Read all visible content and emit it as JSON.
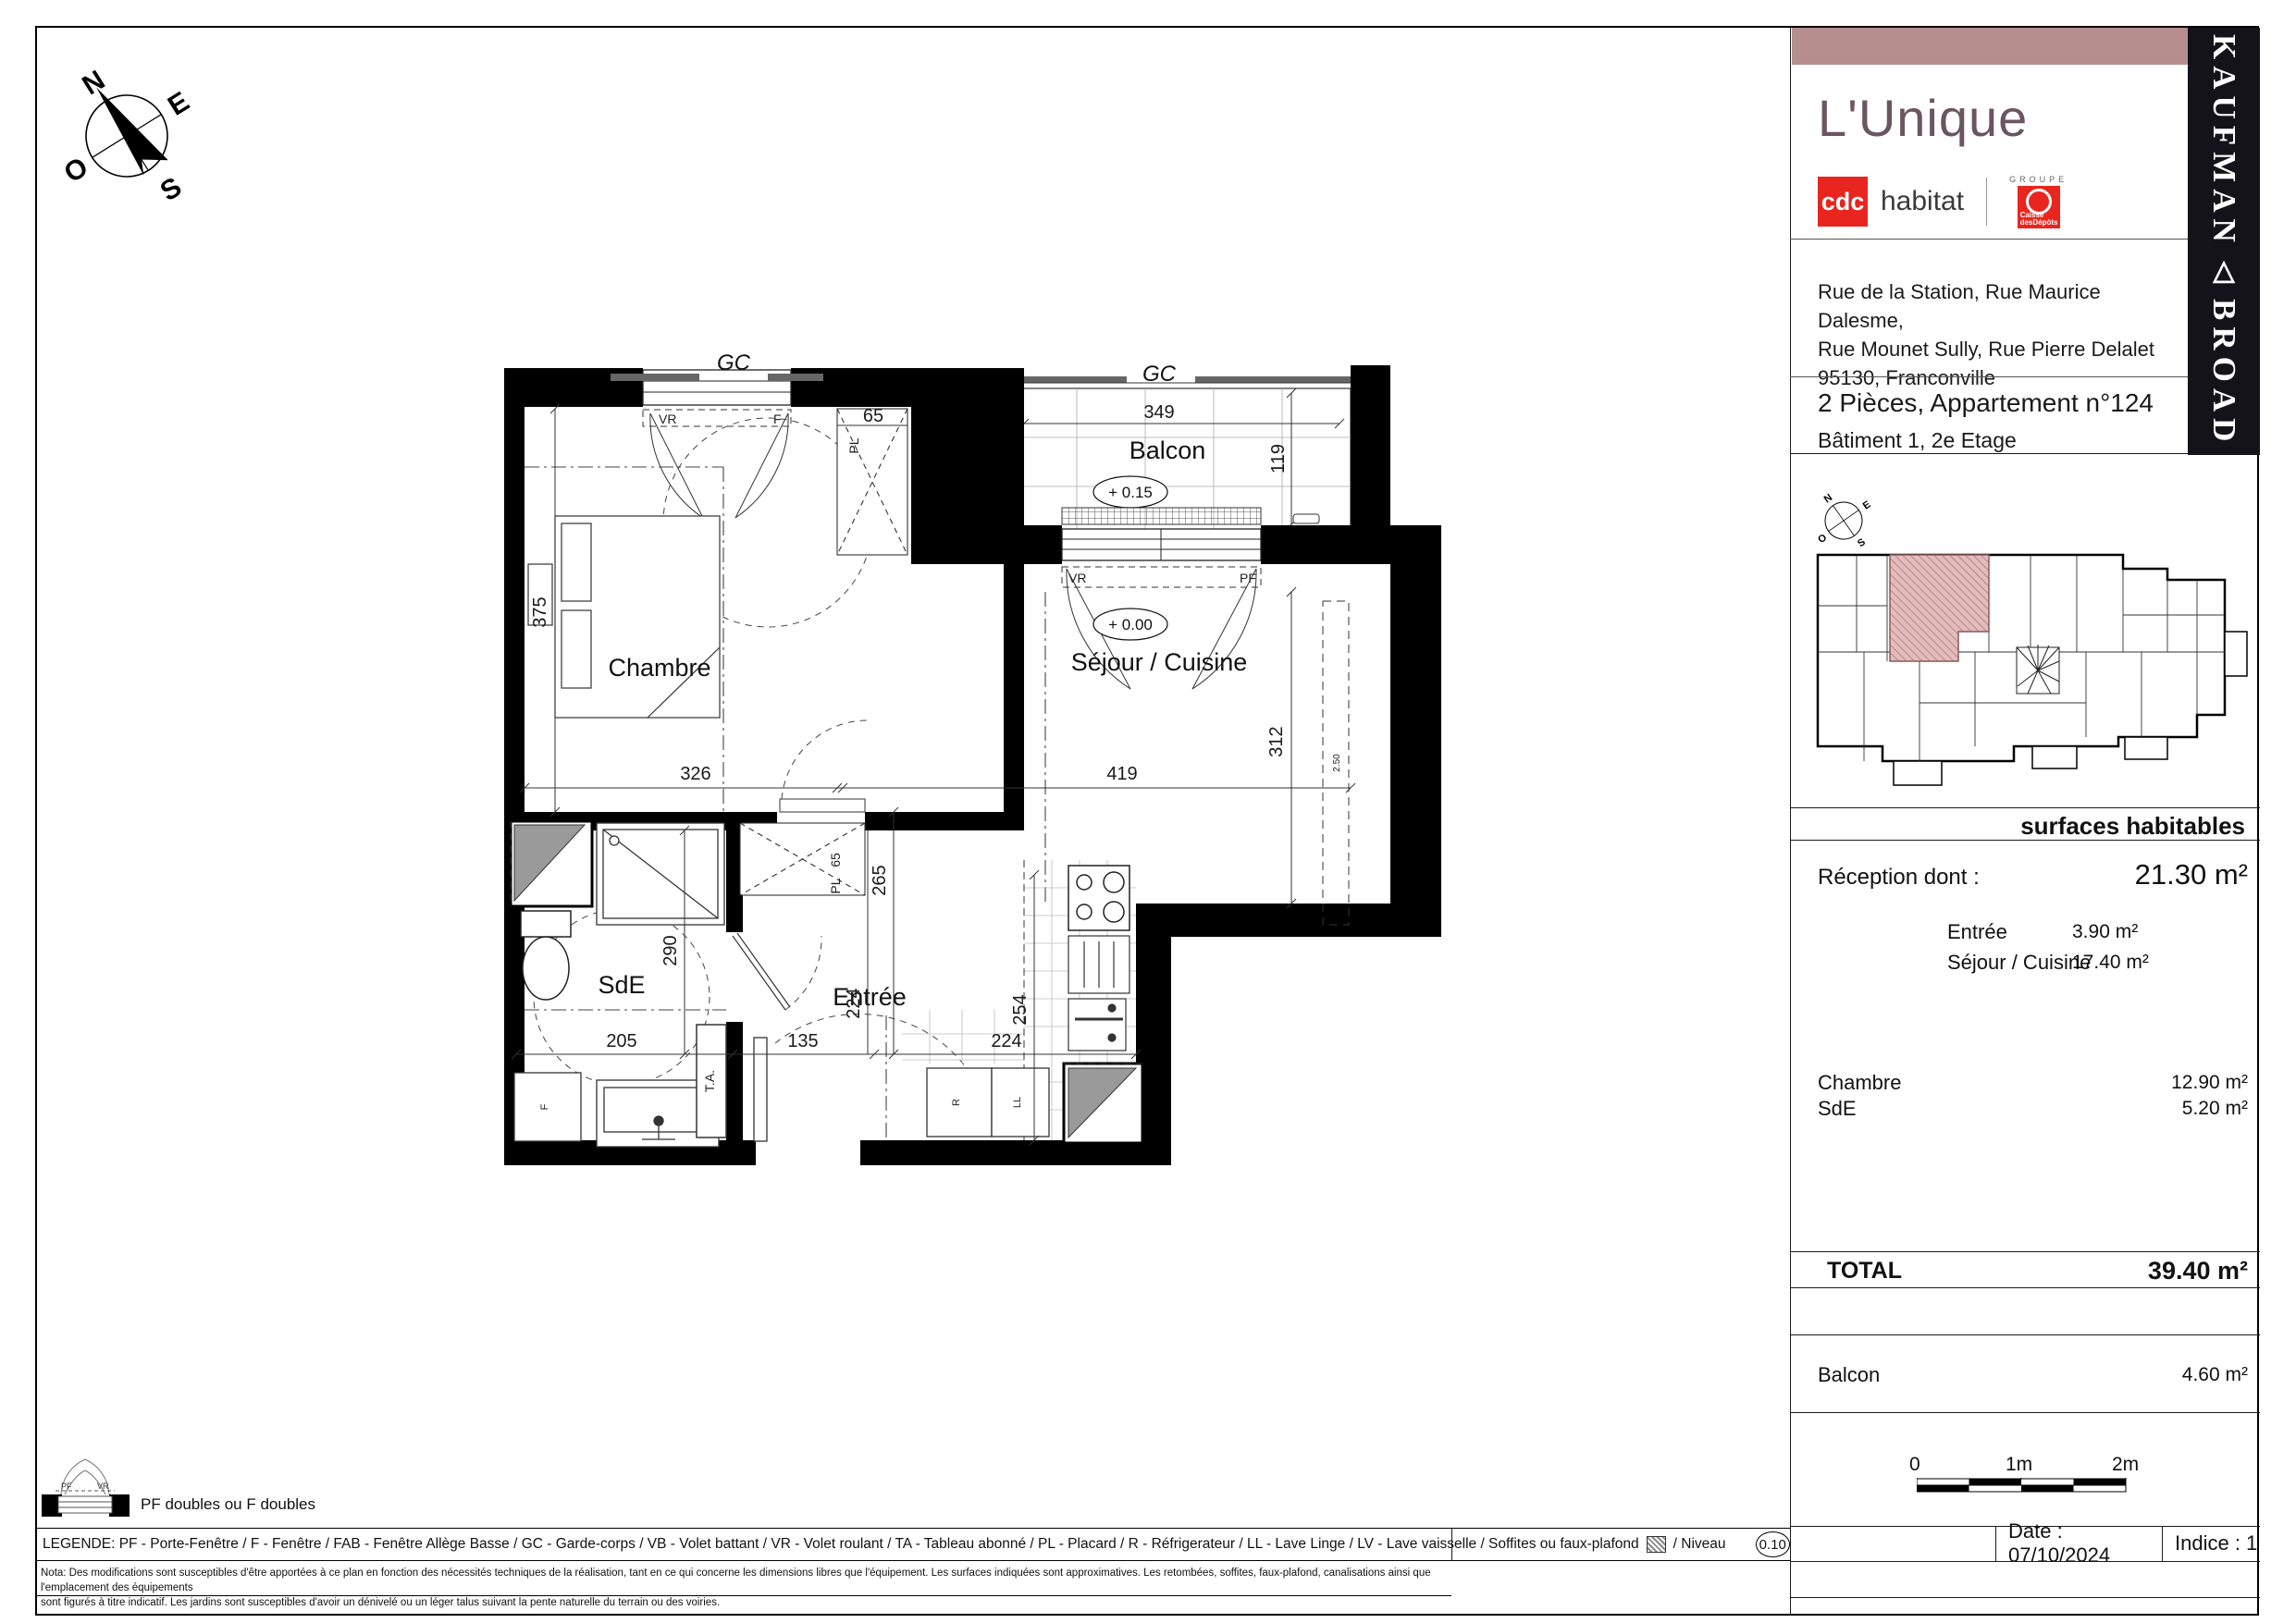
{
  "panel": {
    "title": "L'Unique",
    "brand": {
      "cdc": "cdc",
      "habitat": "habitat",
      "groupe": "GROUPE",
      "caisse_line1": "Caisse",
      "caisse_line2": "desDépôts"
    },
    "kaufman": {
      "top": "KAUFMAN",
      "triangle": "△",
      "bottom": "BROAD"
    },
    "address_lines": [
      "Rue de la Station, Rue Maurice Dalesme,",
      "Rue Mounet Sully, Rue Pierre Delalet",
      "95130, Franconville"
    ],
    "apt_line1": "2 Pièces, Appartement n°124",
    "apt_line2": "Bâtiment 1, 2e Etage",
    "surfaces": {
      "header": "surfaces habitables",
      "reception": {
        "label": "Réception dont :",
        "value": "21.30 m²"
      },
      "details": [
        {
          "label": "Entrée",
          "value": "3.90 m²"
        },
        {
          "label": "Séjour / Cuisine",
          "value": "17.40 m²"
        }
      ],
      "rooms": [
        {
          "label": "Chambre",
          "value": "12.90 m²"
        },
        {
          "label": "SdE",
          "value": "5.20 m²"
        }
      ],
      "total": {
        "label": "TOTAL",
        "value": "39.40 m²"
      },
      "balcon": {
        "label": "Balcon",
        "value": "4.60 m²"
      }
    },
    "scale": {
      "t0": "0",
      "t1": "1m",
      "t2": "2m"
    },
    "footer": {
      "date": "Date : 07/10/2024",
      "indice": "Indice : 1"
    }
  },
  "plan": {
    "rooms": {
      "chambre": "Chambre",
      "sejour": "Séjour / Cuisine",
      "balcon": "Balcon",
      "sde": "SdE",
      "entree": "Entrée"
    },
    "levels": {
      "balcon": "+ 0.15",
      "sejour": "+ 0.00"
    },
    "labels": {
      "gc": "GC",
      "pl": "PL",
      "pl65": "65",
      "ta": "T.A.",
      "vr": "VR",
      "pf": "PF",
      "f_win": "F",
      "f_box": "F",
      "r": "R",
      "ll": "LL",
      "soffit": "2.50"
    },
    "dims": {
      "d65": "65",
      "d349": "349",
      "d119": "119",
      "d375": "375",
      "d326": "326",
      "d419": "419",
      "d312": "312",
      "d265": "265",
      "d290": "290",
      "d205": "205",
      "d135": "135",
      "d224v": "224",
      "d254": "254",
      "d224h": "224"
    },
    "compass": {
      "n": "N",
      "e": "E",
      "s": "S",
      "o": "O"
    }
  },
  "legend": {
    "picto_label": "PF doubles ou F doubles",
    "picto_pf": "PF",
    "picto_vr": "VR",
    "prefix": "LEGENDE:  PF - Porte-Fenêtre / F - Fenêtre / FAB - Fenêtre Allège Basse / GC - Garde-corps / VB - Volet battant / VR - Volet roulant / TA - Tableau abonné / PL - Placard / R - Réfrigerateur / LL - Lave Linge / LV - Lave vaisselle / Soffites ou faux-plafond",
    "niveau_label": "/ Niveau",
    "niveau_value": "0.10",
    "nota_lines": [
      "Nota: Des modifications sont susceptibles d'être apportées à ce plan en fonction des nécessités techniques de la réalisation, tant en ce qui concerne les dimensions libres que l'équipement. Les surfaces indiquées sont approximatives. Les retombées, soffites, faux-plafond, canalisations ainsi que l'emplacement des équipements",
      "sont figurés à titre indicatif. Les jardins sont susceptibles d'avoir un dénivelé ou un léger talus suivant la pente naturelle du terrain ou des voiries."
    ]
  },
  "colors": {
    "rose_bar": "#b78e8e",
    "title": "#6b5560",
    "cdc_red": "#e8251f",
    "banner_black": "#15131a",
    "highlight_fill": "#e3bcbc",
    "highlight_hatch": "#a96f6f"
  }
}
